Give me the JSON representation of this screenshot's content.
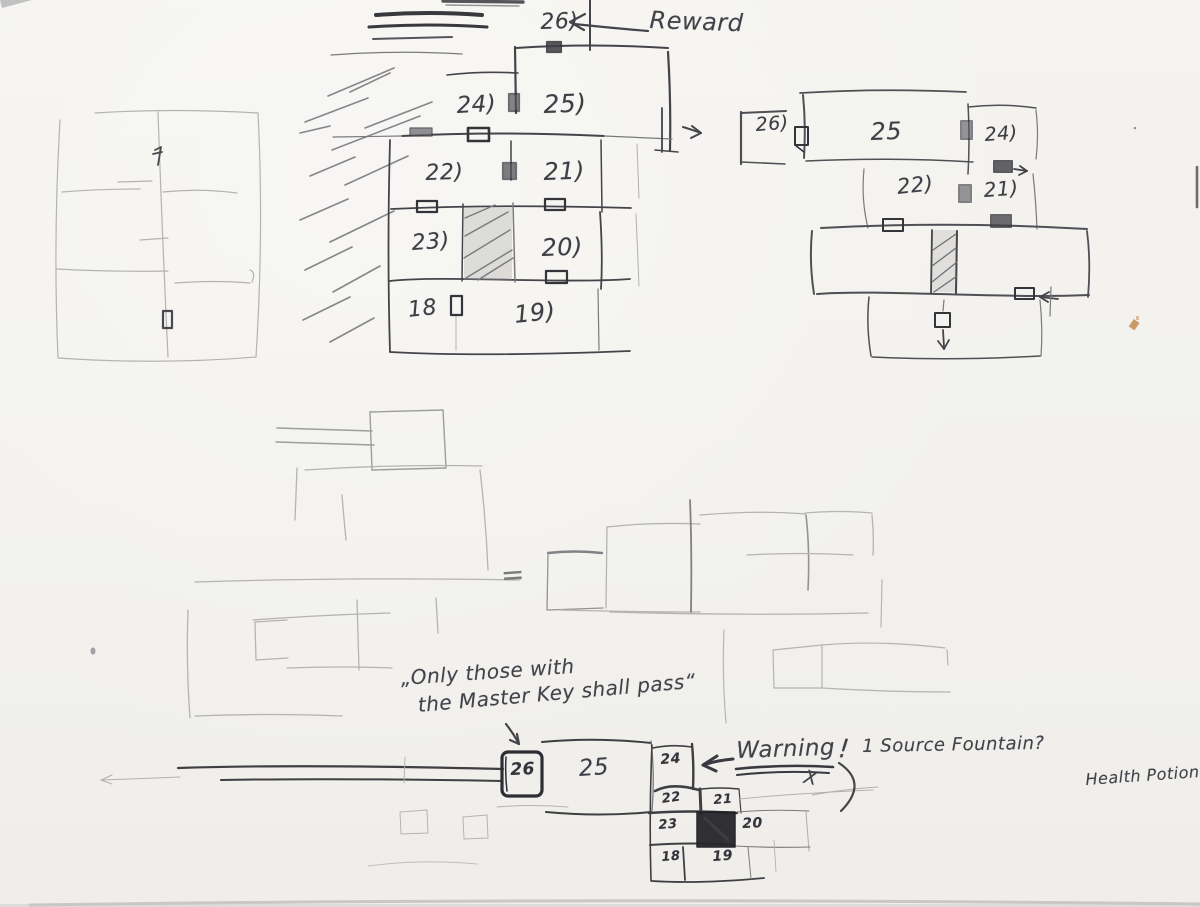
{
  "palette": {
    "paper": "#f3f2ee",
    "pencil_dark": "#45444b",
    "pencil_mid": "#7a797e",
    "pencil_faint": "#b3b1ae",
    "ink_bold": "#2e2d33",
    "speck_orange": "#c08347"
  },
  "annotations": {
    "reward": "Reward",
    "equals": "=",
    "quote_line1": "„Only those with",
    "quote_line2": "the Master Key shall pass“",
    "warning": "Warning",
    "warning_exclamation": "!",
    "warning_x": "X",
    "question_fountain": "1 Source Fountain?",
    "question_potion": "Health Potion?"
  },
  "maps": {
    "main": {
      "rooms": [
        {
          "label": "26)"
        },
        {
          "label": "24)"
        },
        {
          "label": "25)"
        },
        {
          "label": "22)"
        },
        {
          "label": "21)"
        },
        {
          "label": "23)"
        },
        {
          "label": "20)"
        },
        {
          "label": "18"
        },
        {
          "label": "19)"
        }
      ]
    },
    "right": {
      "rooms": [
        {
          "label": "26)"
        },
        {
          "label": "25"
        },
        {
          "label": "24)"
        },
        {
          "label": "22)"
        },
        {
          "label": "21)"
        }
      ]
    },
    "bottom": {
      "rooms": [
        {
          "label": "26"
        },
        {
          "label": "25"
        },
        {
          "label": "24"
        },
        {
          "label": "22"
        },
        {
          "label": "21"
        },
        {
          "label": "23"
        },
        {
          "label": "20"
        },
        {
          "label": "18"
        },
        {
          "label": "19"
        }
      ]
    }
  }
}
